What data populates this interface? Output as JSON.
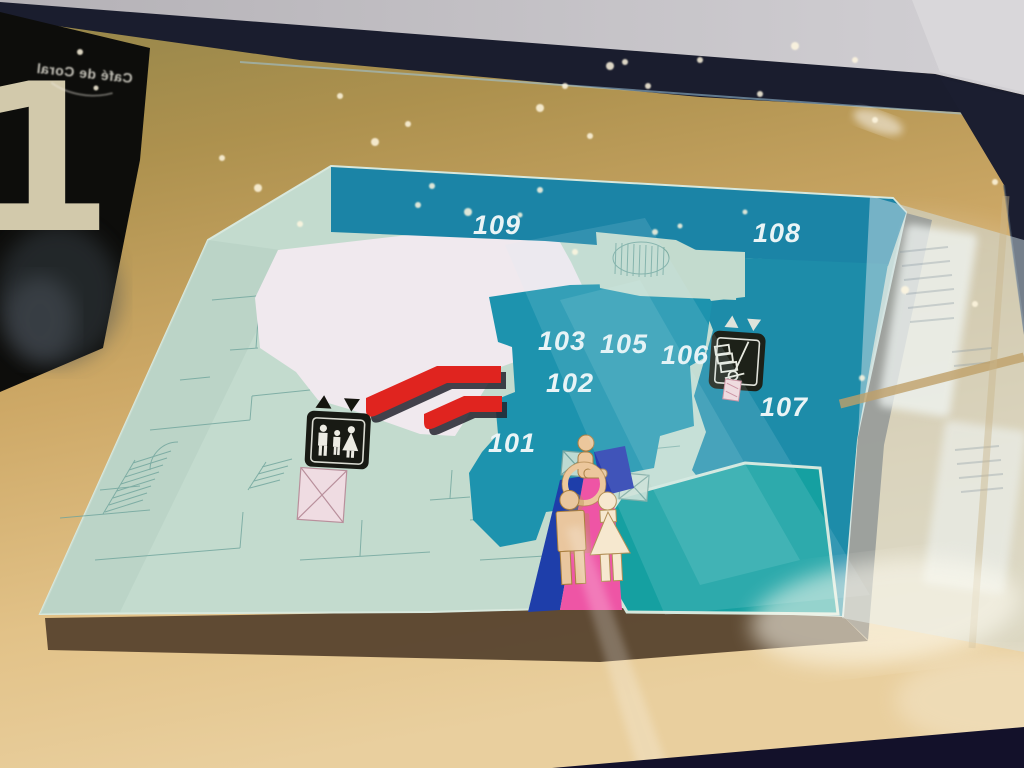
{
  "sign": {
    "floor_number": "1",
    "reflection_text": "Café de Coral"
  },
  "map": {
    "units": [
      {
        "label": "101"
      },
      {
        "label": "102"
      },
      {
        "label": "103"
      },
      {
        "label": "105"
      },
      {
        "label": "106"
      },
      {
        "label": "107"
      },
      {
        "label": "108"
      },
      {
        "label": "109"
      }
    ],
    "icons": [
      {
        "name": "passenger-elevator-icon"
      },
      {
        "name": "freight-elevator-icon"
      },
      {
        "name": "accessible-restroom-icon"
      },
      {
        "name": "mens-restroom-icon"
      },
      {
        "name": "womens-restroom-icon"
      },
      {
        "name": "escalator-icon"
      },
      {
        "name": "stairs-icon"
      },
      {
        "name": "elevator-shaft-icon"
      }
    ],
    "colors": {
      "teal_unit": "#1d8fab",
      "teal_bottom": "#15a0a1",
      "floor": "#c3dbce",
      "anchor_white": "#f0e9ee",
      "escalator_red": "#e0241f",
      "mens_blue": "#1e3eaa",
      "womens_pink": "#ee55a5",
      "sign_tan": "#c9a763",
      "frame_navy": "#1a1d2e",
      "panel_black": "#0d0d0b"
    }
  }
}
